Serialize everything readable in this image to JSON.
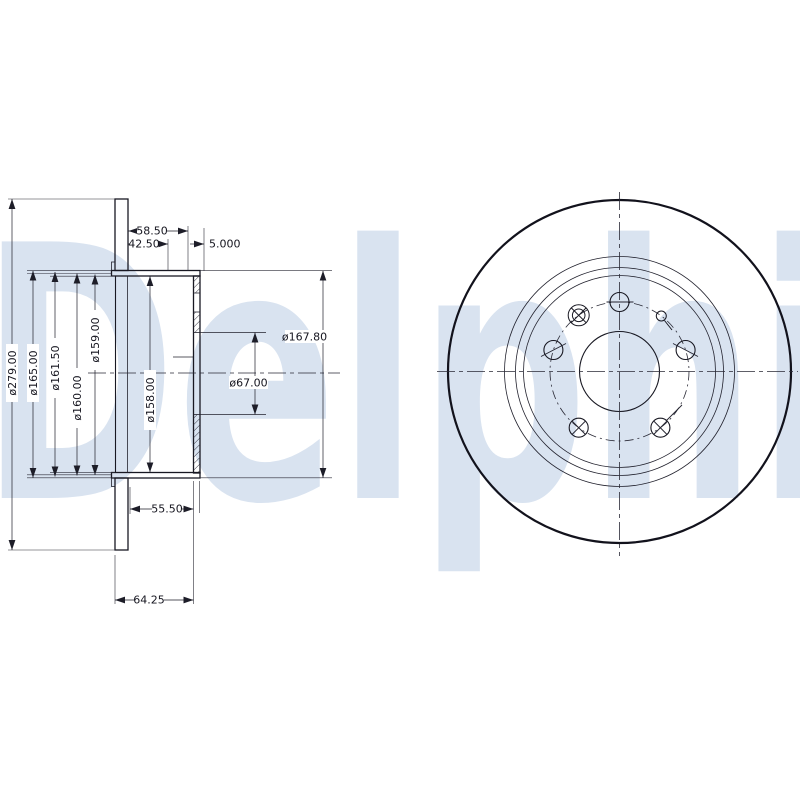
{
  "watermark_text": "Delphi",
  "drawing": {
    "section_view": {
      "diameter_labels": {
        "d279": "ø279.00",
        "d165": "ø165.00",
        "d161_5": "ø161.50",
        "d160": "ø160.00",
        "d159": "ø159.00",
        "d158": "ø158.00",
        "d167_8": "ø167.80",
        "d67": "ø67.00"
      },
      "linear_labels": {
        "w58_5": "58.50",
        "w42_5": "42.50",
        "w5": "5.000",
        "w55_5": "55.50",
        "w64_25": "64.25"
      }
    },
    "front_view": {
      "bolt_holes": 5,
      "set_screw_holes": 1,
      "locating_pin_holes": 1
    },
    "colors": {
      "line": "#1b1b26",
      "watermark": "#d9e3f0"
    }
  }
}
